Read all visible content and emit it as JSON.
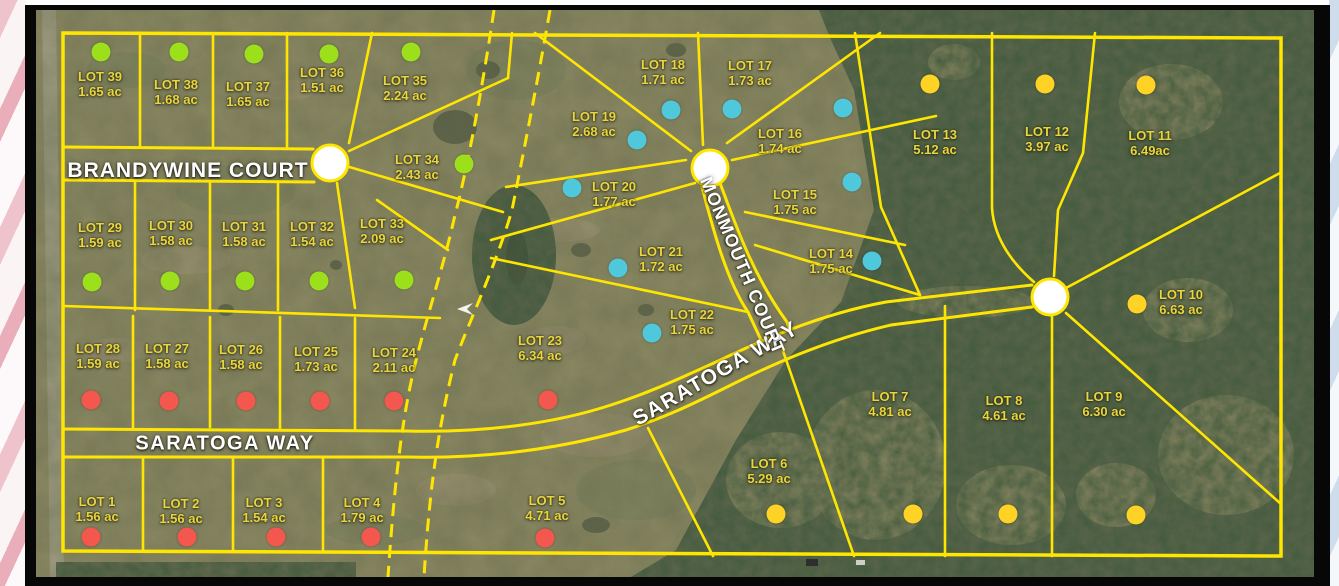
{
  "map": {
    "colors": {
      "boundary_line": "#ffe600",
      "lot_label_text": "#e9d53f",
      "street_text": "#ffffff",
      "dot_colors": {
        "green": "#9ce01c",
        "red": "#f4574d",
        "blue": "#4fc8db",
        "yellow": "#ffd226"
      }
    },
    "streets": [
      {
        "id": "brandywine-court",
        "label": "BRANDYWINE COURT",
        "x": 188,
        "y": 171,
        "angle": 0,
        "size": 21,
        "spacing": 1
      },
      {
        "id": "saratoga-way-west",
        "label": "SARATOGA WAY",
        "x": 225,
        "y": 444,
        "angle": 0,
        "size": 20,
        "spacing": 1.5
      },
      {
        "id": "saratoga-way-east",
        "label": "SARATOGA WAY",
        "x": 716,
        "y": 374,
        "angle": -30,
        "size": 21,
        "spacing": 1.5
      },
      {
        "id": "monmouth-court",
        "label": "MONMOUTH COURT",
        "x": 742,
        "y": 266,
        "angle": 67,
        "size": 18,
        "spacing": 1
      }
    ],
    "lots": [
      {
        "name": "LOT 1",
        "acres": "1.56 ac",
        "dot_color": "red",
        "label": [
          97,
          510
        ],
        "dot": [
          91,
          537
        ]
      },
      {
        "name": "LOT 2",
        "acres": "1.56 ac",
        "dot_color": "red",
        "label": [
          181,
          512
        ],
        "dot": [
          187,
          537
        ]
      },
      {
        "name": "LOT 3",
        "acres": "1.54 ac",
        "dot_color": "red",
        "label": [
          264,
          511
        ],
        "dot": [
          276,
          537
        ]
      },
      {
        "name": "LOT 4",
        "acres": "1.79 ac",
        "dot_color": "red",
        "label": [
          362,
          511
        ],
        "dot": [
          371,
          537
        ]
      },
      {
        "name": "LOT 5",
        "acres": "4.71 ac",
        "dot_color": "red",
        "label": [
          547,
          509
        ],
        "dot": [
          545,
          538
        ]
      },
      {
        "name": "LOT 6",
        "acres": "5.29 ac",
        "dot_color": "yellow",
        "label": [
          769,
          472
        ],
        "dot": [
          776,
          514
        ]
      },
      {
        "name": "LOT 7",
        "acres": "4.81 ac",
        "dot_color": "yellow",
        "label": [
          890,
          405
        ],
        "dot": [
          913,
          514
        ]
      },
      {
        "name": "LOT 8",
        "acres": "4.61 ac",
        "dot_color": "yellow",
        "label": [
          1004,
          409
        ],
        "dot": [
          1008,
          514
        ]
      },
      {
        "name": "LOT 9",
        "acres": "6.30 ac",
        "dot_color": "yellow",
        "label": [
          1104,
          405
        ],
        "dot": [
          1136,
          515
        ]
      },
      {
        "name": "LOT 10",
        "acres": "6.63 ac",
        "dot_color": "yellow",
        "label": [
          1181,
          303
        ],
        "dot": [
          1137,
          304
        ]
      },
      {
        "name": "LOT 11",
        "acres": "6.49ac",
        "dot_color": "yellow",
        "label": [
          1150,
          144
        ],
        "dot": [
          1146,
          85
        ]
      },
      {
        "name": "LOT 12",
        "acres": "3.97 ac",
        "dot_color": "yellow",
        "label": [
          1047,
          140
        ],
        "dot": [
          1045,
          84
        ]
      },
      {
        "name": "LOT 13",
        "acres": "5.12 ac",
        "dot_color": "yellow",
        "label": [
          935,
          143
        ],
        "dot": [
          930,
          84
        ]
      },
      {
        "name": "LOT 14",
        "acres": "1.75 ac",
        "dot_color": "blue",
        "label": [
          831,
          262
        ],
        "dot": [
          872,
          261
        ]
      },
      {
        "name": "LOT 15",
        "acres": "1.75 ac",
        "dot_color": "blue",
        "label": [
          795,
          203
        ],
        "dot": [
          852,
          182
        ]
      },
      {
        "name": "LOT 16",
        "acres": "1.74 ac",
        "dot_color": "blue",
        "label": [
          780,
          142
        ],
        "dot": [
          843,
          108
        ]
      },
      {
        "name": "LOT 17",
        "acres": "1.73 ac",
        "dot_color": "blue",
        "label": [
          750,
          74
        ],
        "dot": [
          732,
          109
        ]
      },
      {
        "name": "LOT 18",
        "acres": "1.71 ac",
        "dot_color": "blue",
        "label": [
          663,
          73
        ],
        "dot": [
          671,
          110
        ]
      },
      {
        "name": "LOT 19",
        "acres": "2.68 ac",
        "dot_color": "blue",
        "label": [
          594,
          125
        ],
        "dot": [
          637,
          140
        ]
      },
      {
        "name": "LOT 20",
        "acres": "1.77 ac",
        "dot_color": "blue",
        "label": [
          614,
          195
        ],
        "dot": [
          572,
          188
        ]
      },
      {
        "name": "LOT 21",
        "acres": "1.72 ac",
        "dot_color": "blue",
        "label": [
          661,
          260
        ],
        "dot": [
          618,
          268
        ]
      },
      {
        "name": "LOT 22",
        "acres": "1.75 ac",
        "dot_color": "blue",
        "label": [
          692,
          323
        ],
        "dot": [
          652,
          333
        ]
      },
      {
        "name": "LOT 23",
        "acres": "6.34 ac",
        "dot_color": "red",
        "label": [
          540,
          349
        ],
        "dot": [
          548,
          400
        ]
      },
      {
        "name": "LOT 24",
        "acres": "2.11 ac",
        "dot_color": "red",
        "label": [
          394,
          361
        ],
        "dot": [
          394,
          401
        ]
      },
      {
        "name": "LOT 25",
        "acres": "1.73 ac",
        "dot_color": "red",
        "label": [
          316,
          360
        ],
        "dot": [
          320,
          401
        ]
      },
      {
        "name": "LOT 26",
        "acres": "1.58 ac",
        "dot_color": "red",
        "label": [
          241,
          358
        ],
        "dot": [
          246,
          401
        ]
      },
      {
        "name": "LOT 27",
        "acres": "1.58 ac",
        "dot_color": "red",
        "label": [
          167,
          357
        ],
        "dot": [
          169,
          401
        ]
      },
      {
        "name": "LOT 28",
        "acres": "1.59 ac",
        "dot_color": "red",
        "label": [
          98,
          357
        ],
        "dot": [
          91,
          400
        ]
      },
      {
        "name": "LOT 29",
        "acres": "1.59 ac",
        "dot_color": "green",
        "label": [
          100,
          236
        ],
        "dot": [
          92,
          282
        ]
      },
      {
        "name": "LOT 30",
        "acres": "1.58 ac",
        "dot_color": "green",
        "label": [
          171,
          234
        ],
        "dot": [
          170,
          281
        ]
      },
      {
        "name": "LOT 31",
        "acres": "1.58 ac",
        "dot_color": "green",
        "label": [
          244,
          235
        ],
        "dot": [
          245,
          281
        ]
      },
      {
        "name": "LOT 32",
        "acres": "1.54 ac",
        "dot_color": "green",
        "label": [
          312,
          235
        ],
        "dot": [
          319,
          281
        ]
      },
      {
        "name": "LOT 33",
        "acres": "2.09 ac",
        "dot_color": "green",
        "label": [
          382,
          232
        ],
        "dot": [
          404,
          280
        ]
      },
      {
        "name": "LOT 34",
        "acres": "2.43 ac",
        "dot_color": "green",
        "label": [
          417,
          168
        ],
        "dot": [
          464,
          164
        ]
      },
      {
        "name": "LOT 35",
        "acres": "2.24 ac",
        "dot_color": "green",
        "label": [
          405,
          89
        ],
        "dot": [
          411,
          52
        ]
      },
      {
        "name": "LOT 36",
        "acres": "1.51 ac",
        "dot_color": "green",
        "label": [
          322,
          81
        ],
        "dot": [
          329,
          54
        ]
      },
      {
        "name": "LOT 37",
        "acres": "1.65 ac",
        "dot_color": "green",
        "label": [
          248,
          95
        ],
        "dot": [
          254,
          54
        ]
      },
      {
        "name": "LOT 38",
        "acres": "1.68 ac",
        "dot_color": "green",
        "label": [
          176,
          93
        ],
        "dot": [
          179,
          52
        ]
      },
      {
        "name": "LOT 39",
        "acres": "1.65 ac",
        "dot_color": "green",
        "label": [
          100,
          85
        ],
        "dot": [
          101,
          52
        ]
      }
    ]
  }
}
